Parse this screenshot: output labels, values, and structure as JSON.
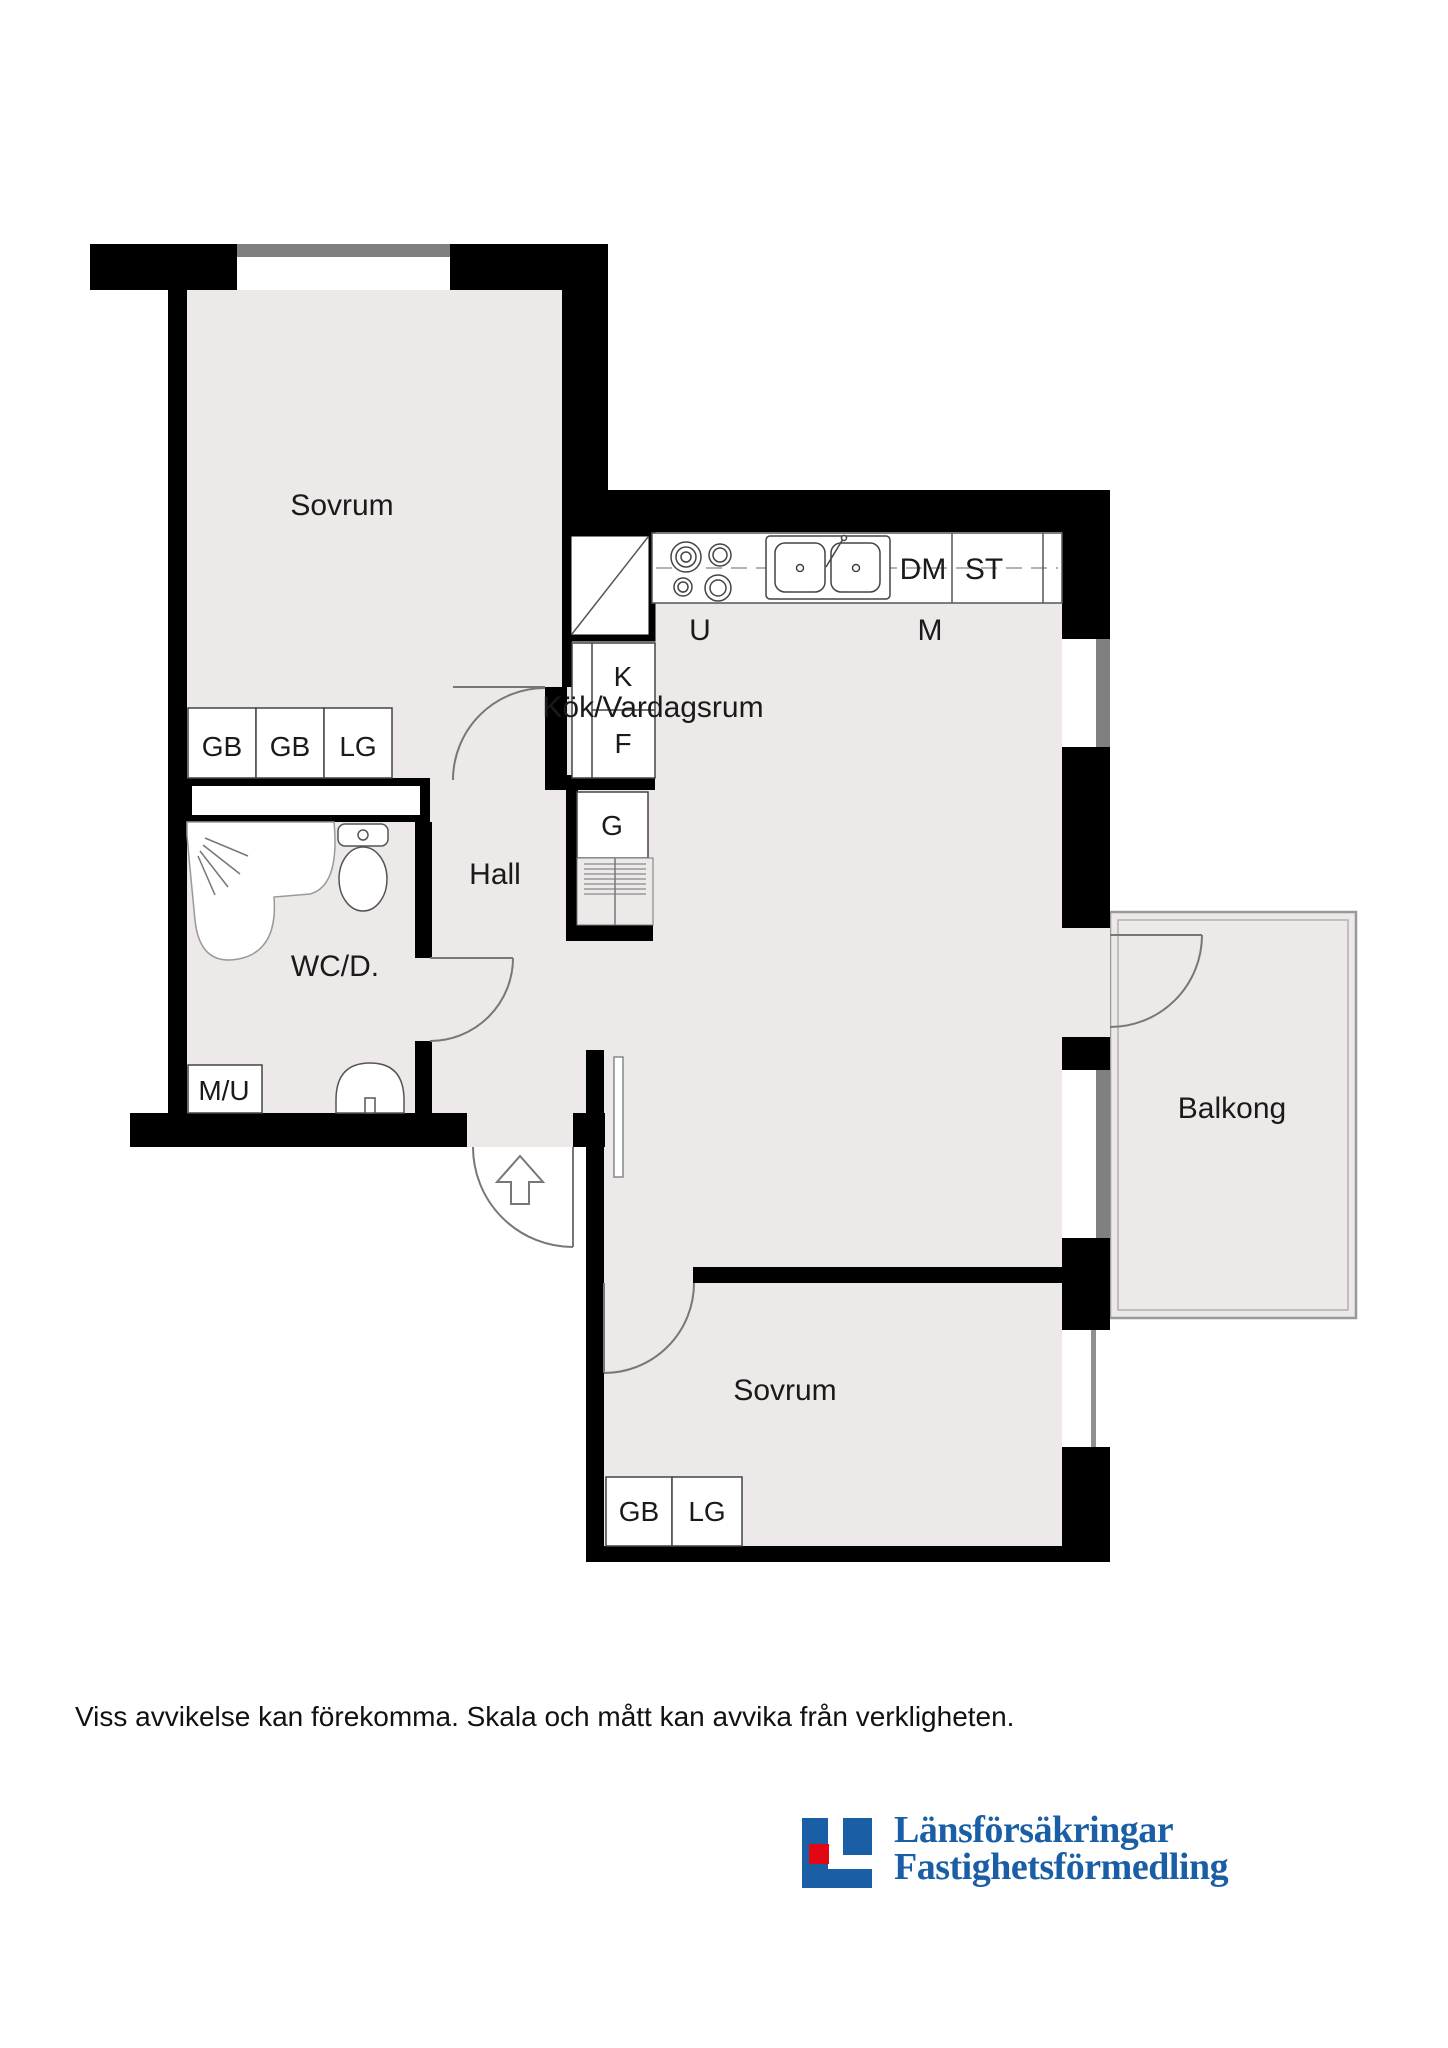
{
  "plan": {
    "rooms": {
      "bedroom_top": "Sovrum",
      "bedroom_bottom": "Sovrum",
      "kitchen_living": "Kök/Vardagsrum",
      "hall": "Hall",
      "bathroom": "WC/D.",
      "balcony": "Balkong"
    },
    "fixtures": {
      "gb": "GB",
      "lg": "LG",
      "k": "K",
      "f": "F",
      "g": "G",
      "mu": "M/U",
      "u": "U",
      "m": "M",
      "dm": "DM",
      "st": "ST"
    }
  },
  "footer": {
    "disclaimer": "Viss avvikelse kan förekomma. Skala och mått kan avvika från verkligheten."
  },
  "logo": {
    "line1": "Länsförsäkringar",
    "line2": "Fastighetsförmedling"
  },
  "colors": {
    "room_fill": "#EDE9E9",
    "wall": "#000000",
    "window_gray": "#808080",
    "logo_blue": "#1A5EA5",
    "logo_red": "#E30613"
  }
}
